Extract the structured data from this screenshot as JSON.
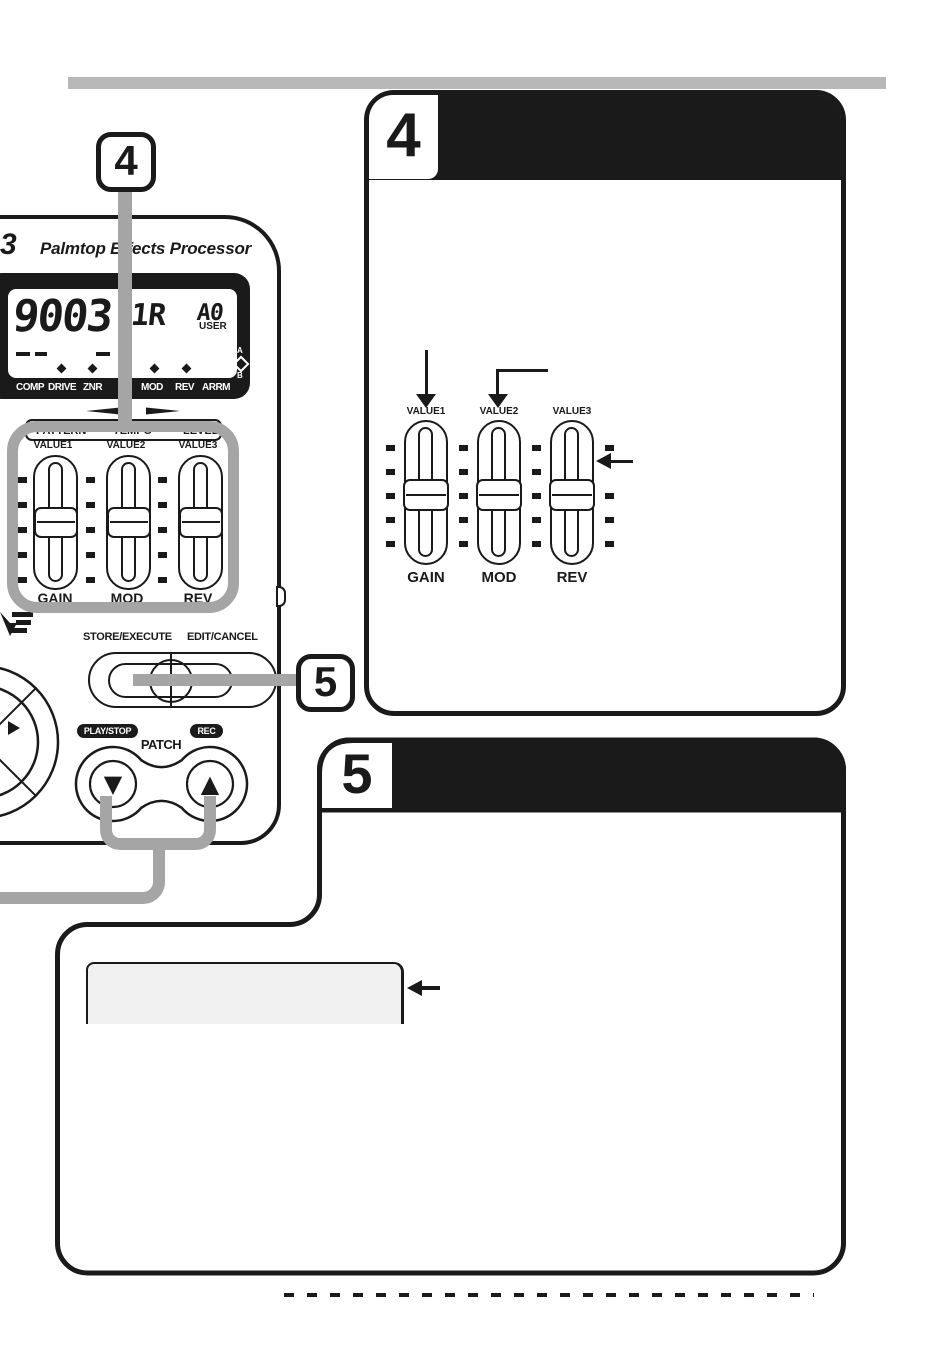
{
  "doc_type": "effects-processor manual page (scanned illustration)",
  "colors": {
    "ink": "#1a1a1a",
    "callout_line_gray": "#a5a5a5",
    "top_rule_gray": "#b8b8b8",
    "screen_fill_gray": "#f0f0f0",
    "paper": "#ffffff"
  },
  "callouts": {
    "four": "4",
    "five": "5"
  },
  "device": {
    "logo_fragment": "3",
    "tagline": "Palmtop Effects Processor",
    "lcd": {
      "patch_digits": "9003",
      "patch_chars": "1r",
      "bank": "A0",
      "bank_mode": "USER",
      "left_indicators": [
        "COMP",
        "DRIVE",
        "ZNR"
      ],
      "right_indicators": [
        "MOD",
        "REV",
        "ARRM"
      ],
      "ab_selector": {
        "top": "A",
        "bottom": "B"
      }
    },
    "function_strip": [
      "PATTERN",
      "TEMPO",
      "LEVEL"
    ],
    "sliders": {
      "value_labels": [
        "VALUE1",
        "VALUE2",
        "VALUE3"
      ],
      "name_labels": [
        "GAIN",
        "MOD",
        "REV"
      ]
    },
    "controls": {
      "store_execute": "STORE/EXECUTE",
      "edit_cancel": "EDIT/CANCEL",
      "play_stop": "PLAY/STOP",
      "rec": "REC",
      "patch": "PATCH",
      "patch_down": "▼",
      "patch_up": "▲"
    }
  },
  "step4_panel": {
    "step_number": "4",
    "value_labels": [
      "VALUE1",
      "VALUE2",
      "VALUE3"
    ],
    "name_labels": [
      "GAIN",
      "MOD",
      "REV"
    ]
  },
  "step5_panel": {
    "step_number": "5"
  }
}
